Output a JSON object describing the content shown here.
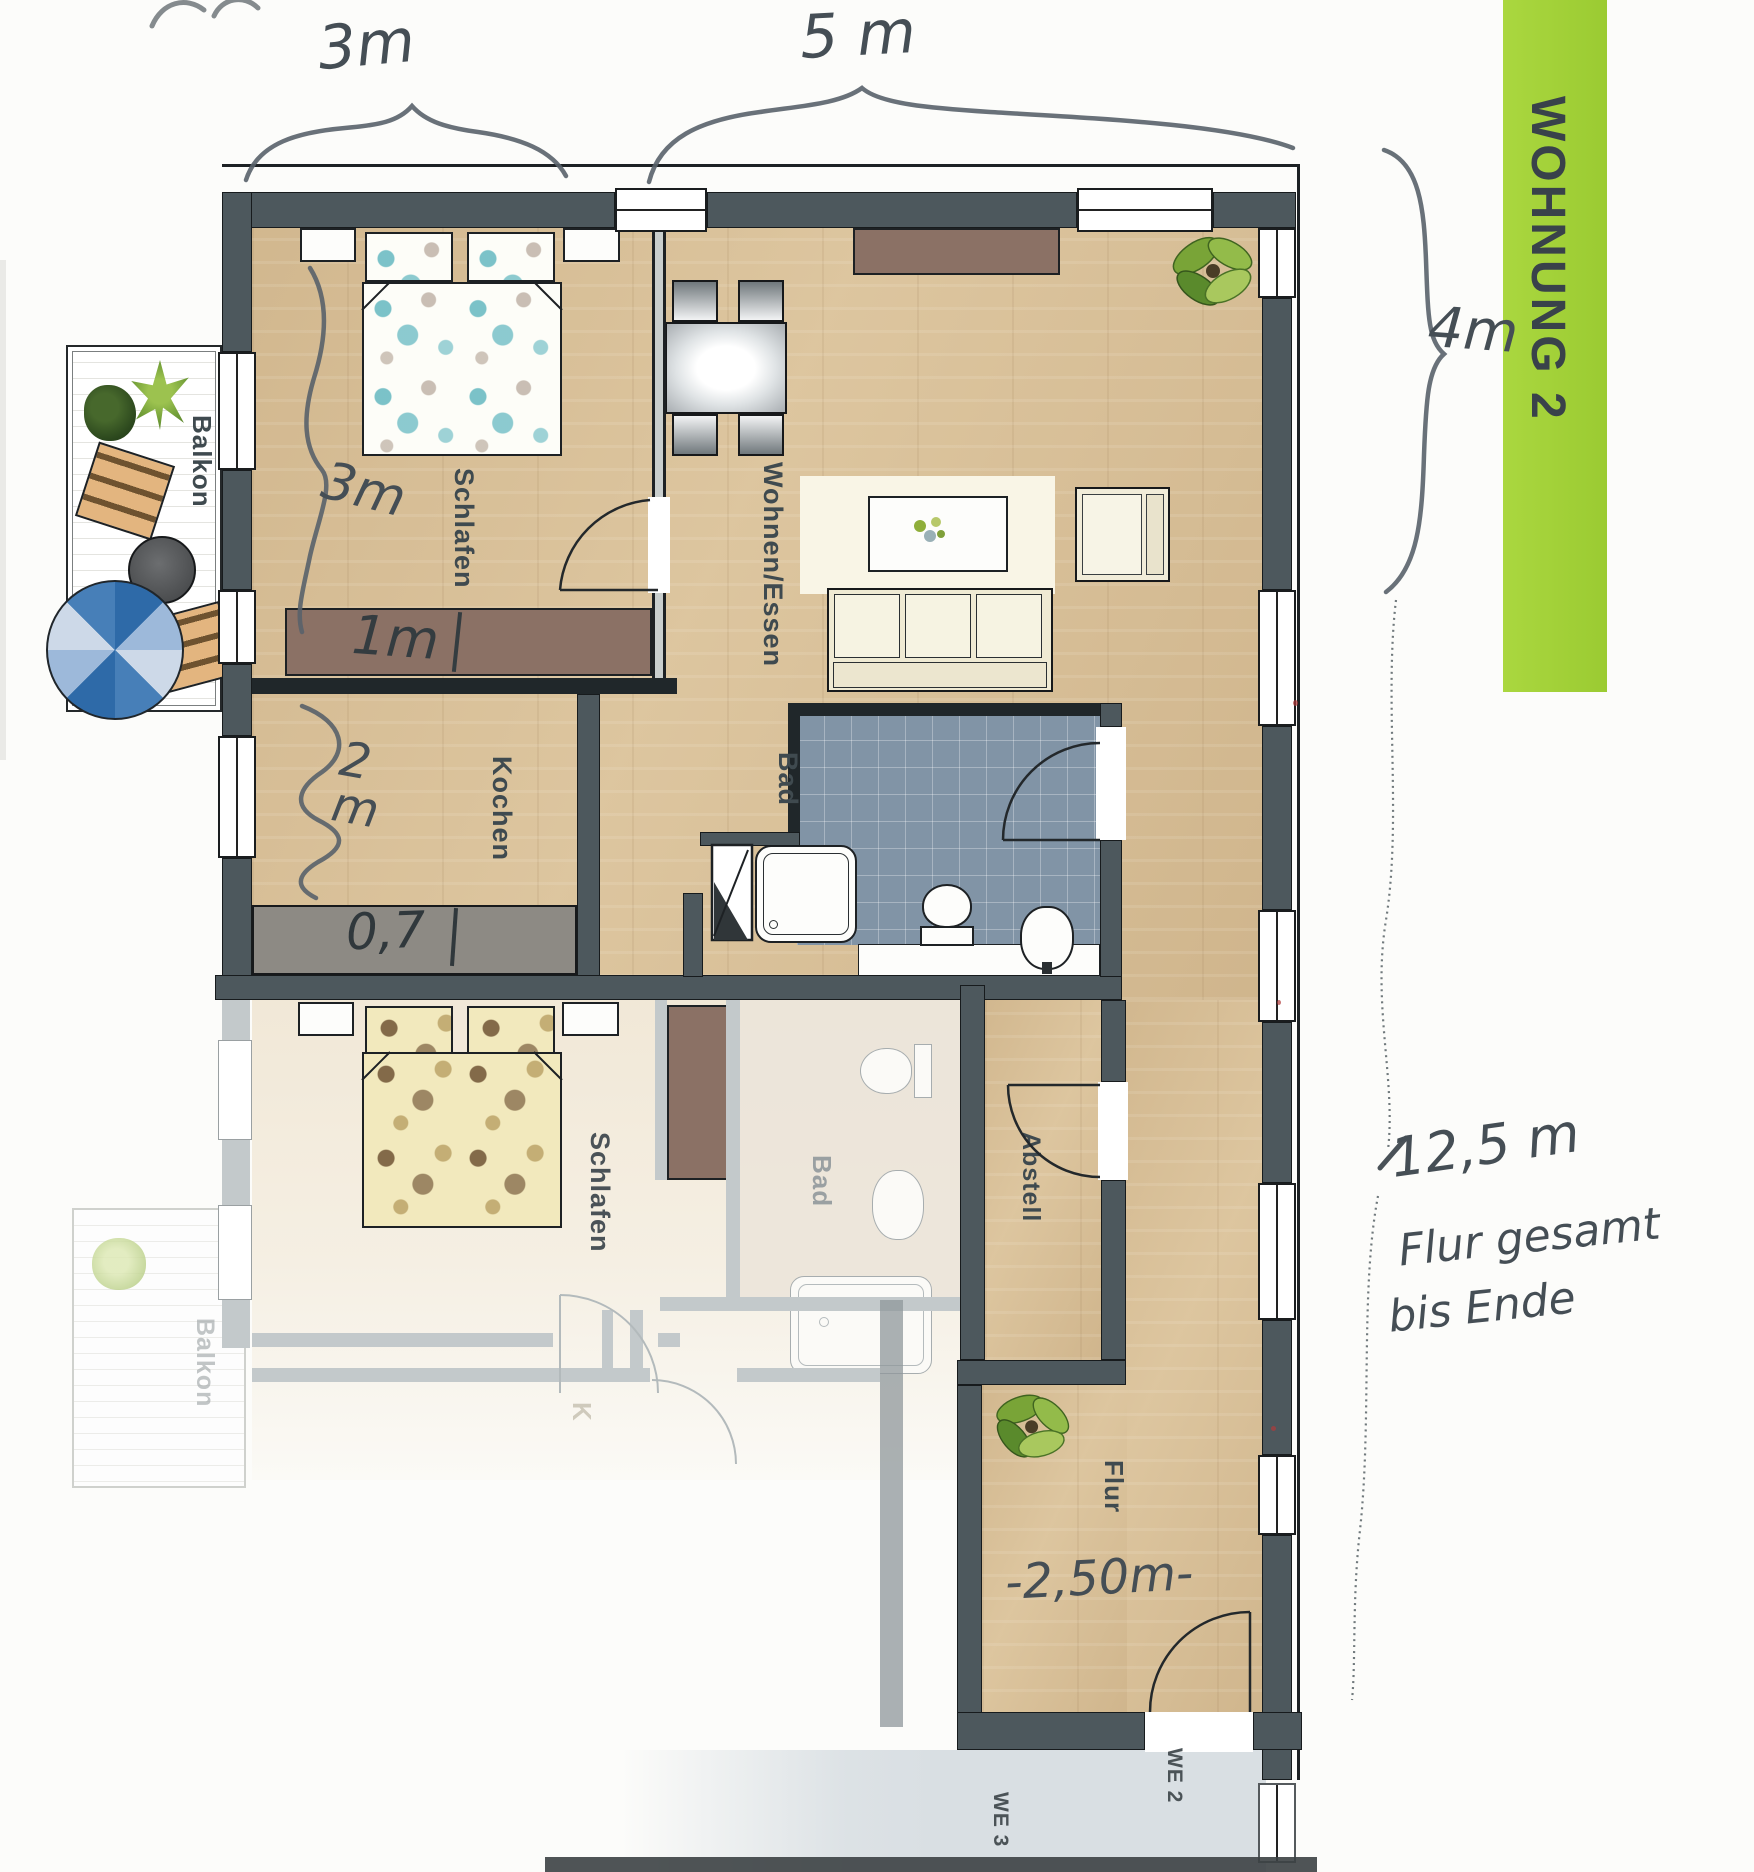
{
  "banner": {
    "label": "WOHNUNG 2"
  },
  "rooms": {
    "schlafen1": "Schlafen",
    "wohnen_essen": "Wohnen/Essen",
    "kochen": "Kochen",
    "bad1": "Bad",
    "schlafen2": "Schlafen",
    "bad2": "Bad",
    "abstell": "Abstell",
    "flur": "Flur",
    "balkon1": "Balkon",
    "balkon2": "Balkon",
    "kochen2_fragment": "K"
  },
  "units": {
    "we2": "WE 2",
    "we3": "WE 3"
  },
  "annotations": {
    "width_schlafen": "3m",
    "width_wohnen": "5 m",
    "height_wohnen": "4m",
    "schlafen_inner_height": "3m",
    "wardrobe_depth": "1m",
    "kochen_depth": "2m",
    "counter_depth": "0,7",
    "flur_width": "-2,50m-",
    "flur_total_line1": "12,5 m",
    "flur_total_line2": "Flur gesamt",
    "flur_total_line3": "bis Ende"
  },
  "colors": {
    "banner_green": "#a6d23c",
    "wall_dark": "#4d585d",
    "wood_floor": "#d9c097",
    "tile_blue": "#8194a6",
    "furniture_mauve": "#8b7165",
    "counter_gray": "#8d8a84",
    "landing_gray": "#d9dfe3",
    "parasol_blue": "#2e6aa8"
  }
}
